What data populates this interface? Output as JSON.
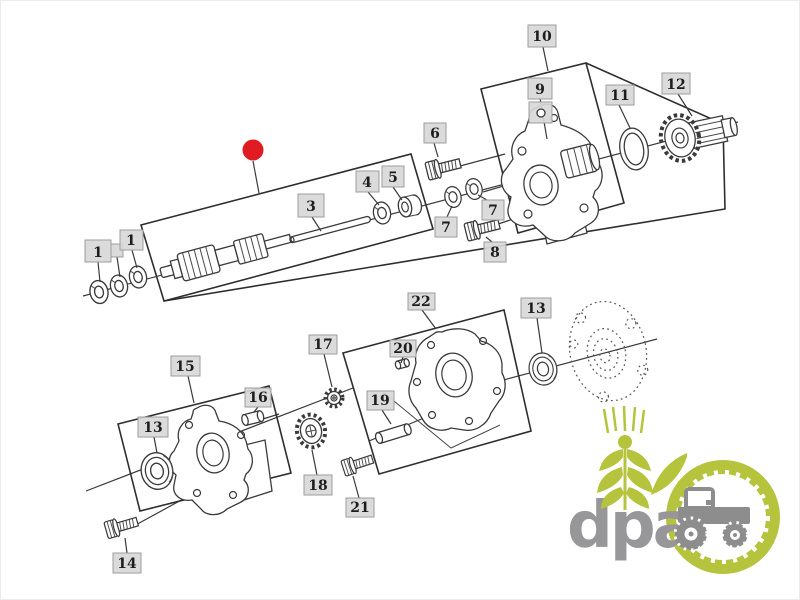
{
  "diagram": {
    "type": "exploded-parts-diagram",
    "callouts": [
      {
        "id": "1a",
        "label": "1"
      },
      {
        "id": "1b",
        "label": "1"
      },
      {
        "id": "3",
        "label": "3"
      },
      {
        "id": "4",
        "label": "4"
      },
      {
        "id": "5",
        "label": "5"
      },
      {
        "id": "6",
        "label": "6"
      },
      {
        "id": "7a",
        "label": "7"
      },
      {
        "id": "7b",
        "label": "7"
      },
      {
        "id": "8",
        "label": "8"
      },
      {
        "id": "9",
        "label": "9"
      },
      {
        "id": "10",
        "label": "10"
      },
      {
        "id": "11",
        "label": "11"
      },
      {
        "id": "12",
        "label": "12"
      },
      {
        "id": "13a",
        "label": "13"
      },
      {
        "id": "13b",
        "label": "13"
      },
      {
        "id": "14",
        "label": "14"
      },
      {
        "id": "15",
        "label": "15"
      },
      {
        "id": "16",
        "label": "16"
      },
      {
        "id": "17",
        "label": "17"
      },
      {
        "id": "18",
        "label": "18"
      },
      {
        "id": "19",
        "label": "19"
      },
      {
        "id": "20",
        "label": "20"
      },
      {
        "id": "21",
        "label": "21"
      },
      {
        "id": "22",
        "label": "22"
      }
    ],
    "marker": {
      "name": "selected-part-marker",
      "shape": "filled-circle",
      "color": "#e11b22"
    },
    "colors": {
      "background": "#ffffff",
      "line": "#3a3a3a",
      "box_outline": "#2e2e2e",
      "callout_fill": "#d8d8d8",
      "callout_border": "#9e9e9e",
      "callout_text": "#1d1d1d"
    }
  },
  "watermark": {
    "text": "dpa",
    "text_color": "#97979a",
    "accent_green": "#b5c43c",
    "tractor_gray": "#8d8d8d"
  }
}
